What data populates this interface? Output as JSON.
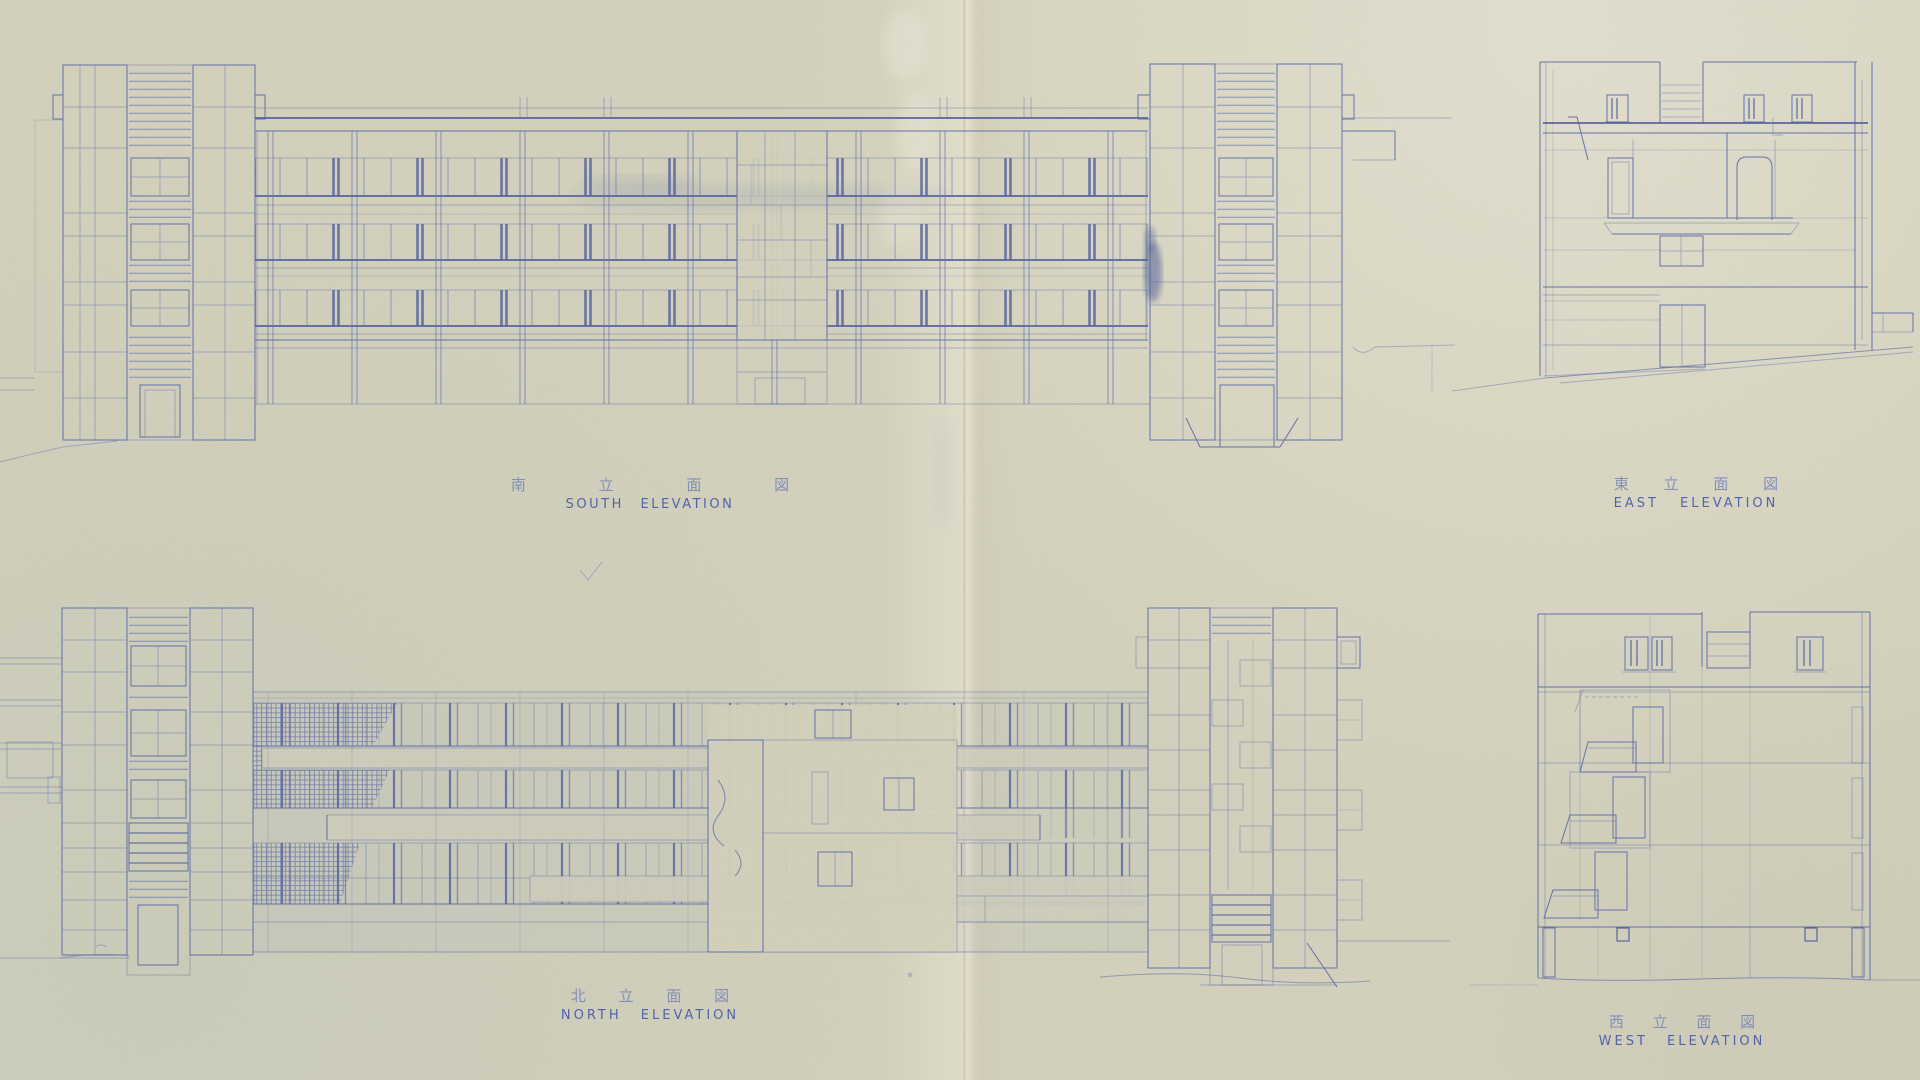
{
  "sheet": {
    "labels": {
      "south": {
        "ja": "南 立 面 図",
        "en": "SOUTH ELEVATION"
      },
      "east": {
        "ja": "東 立 面 図",
        "en": "EAST ELEVATION"
      },
      "north": {
        "ja": "北 立 面 図",
        "en": "NORTH ELEVATION"
      },
      "west": {
        "ja": "西 立 面 図",
        "en": "WEST ELEVATION"
      }
    },
    "colors": {
      "paper": "#d3d1bc",
      "ink": "#5565a6",
      "ink_dark": "#3c4d96",
      "crease": "#c9bb9b"
    }
  }
}
